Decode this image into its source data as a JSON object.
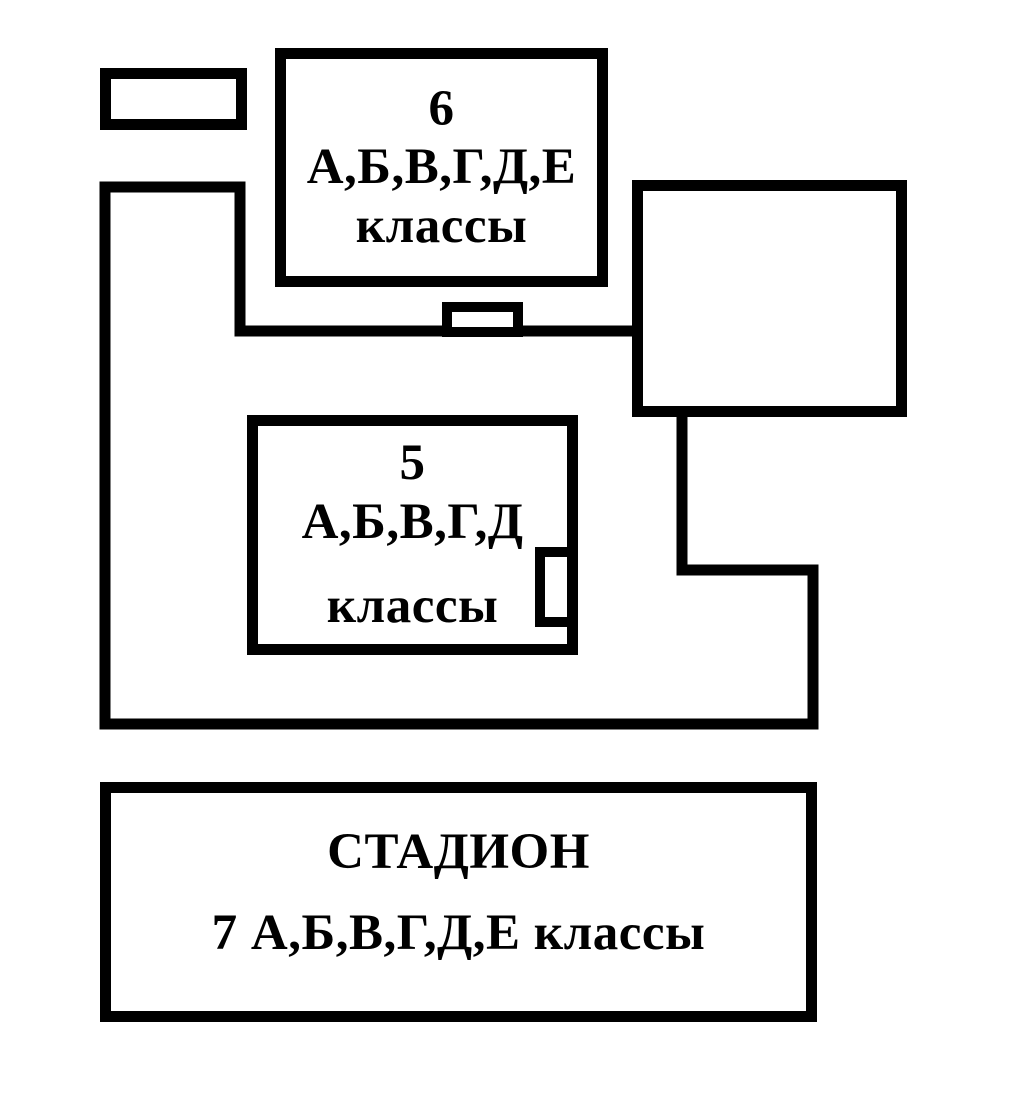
{
  "diagram": {
    "type": "school-grounds-plan",
    "colors": {
      "background": "#ffffff",
      "line": "#000000",
      "text": "#000000"
    },
    "boxes": {
      "grade6": {
        "lines": [
          "6",
          "А,Б,В,Г,Д,Е",
          "классы"
        ]
      },
      "grade5": {
        "lines": [
          "5",
          "А,Б,В,Г,Д",
          "классы"
        ]
      },
      "stadium": {
        "lines": [
          "СТАДИОН",
          "7 А,Б,В,Г,Д,Е классы"
        ]
      }
    }
  }
}
